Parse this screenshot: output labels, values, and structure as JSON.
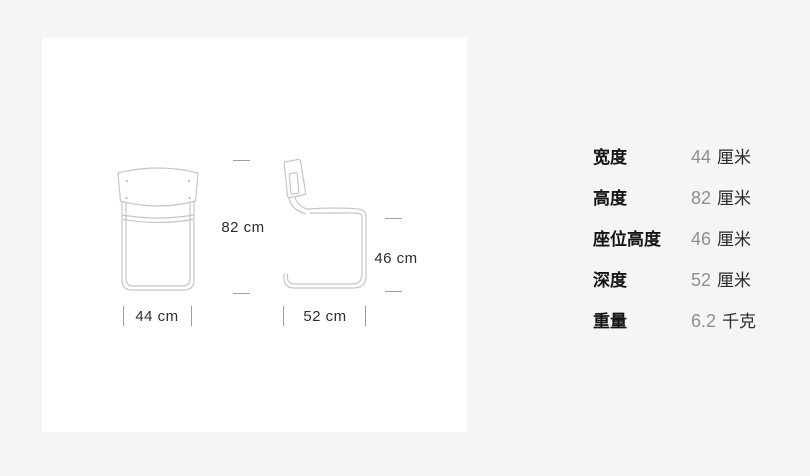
{
  "diagram": {
    "front_view": {
      "name": "chair front view",
      "width_label": "44 cm",
      "height_label": "82 cm"
    },
    "side_view": {
      "name": "chair side view",
      "depth_label": "52 cm",
      "seat_height_label": "46 cm"
    }
  },
  "specs": {
    "rows": [
      {
        "label": "宽度",
        "value": "44",
        "unit": "厘米"
      },
      {
        "label": "高度",
        "value": "82",
        "unit": "厘米"
      },
      {
        "label": "座位高度",
        "value": "46",
        "unit": "厘米"
      },
      {
        "label": "深度",
        "value": "52",
        "unit": "厘米"
      },
      {
        "label": "重量",
        "value": "6.2",
        "unit": "千克"
      }
    ]
  },
  "colors": {
    "page_background": "#f5f5f5",
    "card_background": "#ffffff",
    "line_art": "#c6c6c6",
    "tick": "#9d9d9d",
    "dimension_text": "#2e2e2e",
    "spec_label": "#141414",
    "spec_number": "#8f8f8f",
    "spec_unit": "#2b2b2b"
  }
}
